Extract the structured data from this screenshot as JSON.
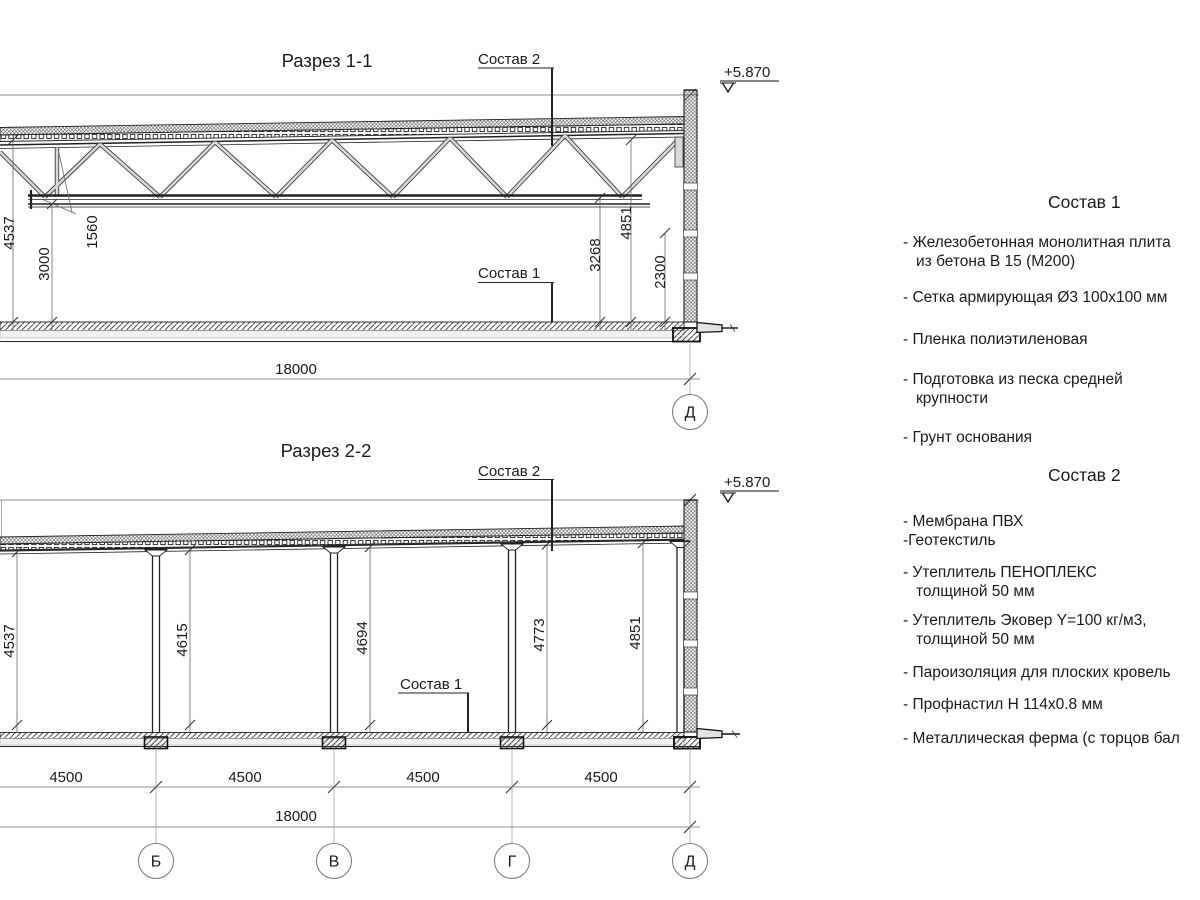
{
  "section1": {
    "title": "Разрез 1-1",
    "label_sostav2": "Состав 2",
    "label_sostav1": "Состав 1",
    "elevation": "+5.870",
    "dim_4537": "4537",
    "dim_1560": "1560",
    "dim_3000": "3000",
    "dim_3268": "3268",
    "dim_4851": "4851",
    "dim_2300": "2300",
    "dim_span": "18000",
    "axis_d": "Д"
  },
  "section2": {
    "title": "Разрез 2-2",
    "label_sostav2": "Состав 2",
    "label_sostav1": "Состав 1",
    "elevation": "+5.870",
    "dim_4537": "4537",
    "dim_4615": "4615",
    "dim_4694": "4694",
    "dim_4773": "4773",
    "dim_4851": "4851",
    "bays": [
      "4500",
      "4500",
      "4500",
      "4500"
    ],
    "dim_span": "18000",
    "axes": [
      "Б",
      "В",
      "Г",
      "Д"
    ]
  },
  "sostav1": {
    "title": "Состав 1",
    "items": [
      "- Железобетонная  монолитная плита\nиз бетона В 15 (М200)",
      "- Сетка армирующая Ø3 100х100 мм",
      "- Пленка полиэтиленовая",
      "- Подготовка из песка средней\nкрупности",
      "- Грунт основания"
    ]
  },
  "sostav2": {
    "title": "Состав 2",
    "items": [
      "- Мембрана ПВХ\n-Геотекстиль",
      "- Утеплитель ПЕНОПЛЕКС\nтолщиной 50 мм",
      "- Утеплитель Эковер Y=100 кг/м3,\nтолщиной 50 мм",
      "- Пароизоляция для плоских кровель",
      "- Профнастил Н 114х0.8 мм",
      "- Металлическая ферма (с торцов бал"
    ]
  },
  "colors": {
    "line": "#222222",
    "dimline": "#666666",
    "member_core": "#d9d9d9",
    "member_edge": "#3f3f3f"
  }
}
